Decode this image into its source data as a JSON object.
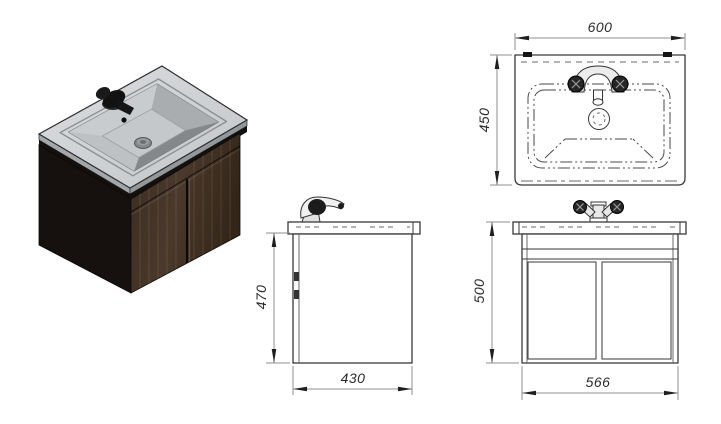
{
  "page": {
    "background": "#ffffff"
  },
  "dimensions": {
    "top_view": {
      "width": "600",
      "depth": "450"
    },
    "side_view": {
      "height": "470",
      "depth": "430"
    },
    "front_view": {
      "height": "500",
      "width": "566"
    }
  },
  "colors": {
    "object_line": "#3a3a3a",
    "hidden_line": "#6a6a6a",
    "dim_line": "#8f8f8f",
    "dim_text": "#2b2b2b",
    "counter_top": "#ced1d4",
    "basin_floor": "#c5c8ca",
    "basin_shadow_wall": "#84888b",
    "cabinet_front_wood": "#43342a",
    "cabinet_side_dark": "#16110e",
    "faucet_black": "#121212",
    "drain_gray": "#84878a"
  }
}
